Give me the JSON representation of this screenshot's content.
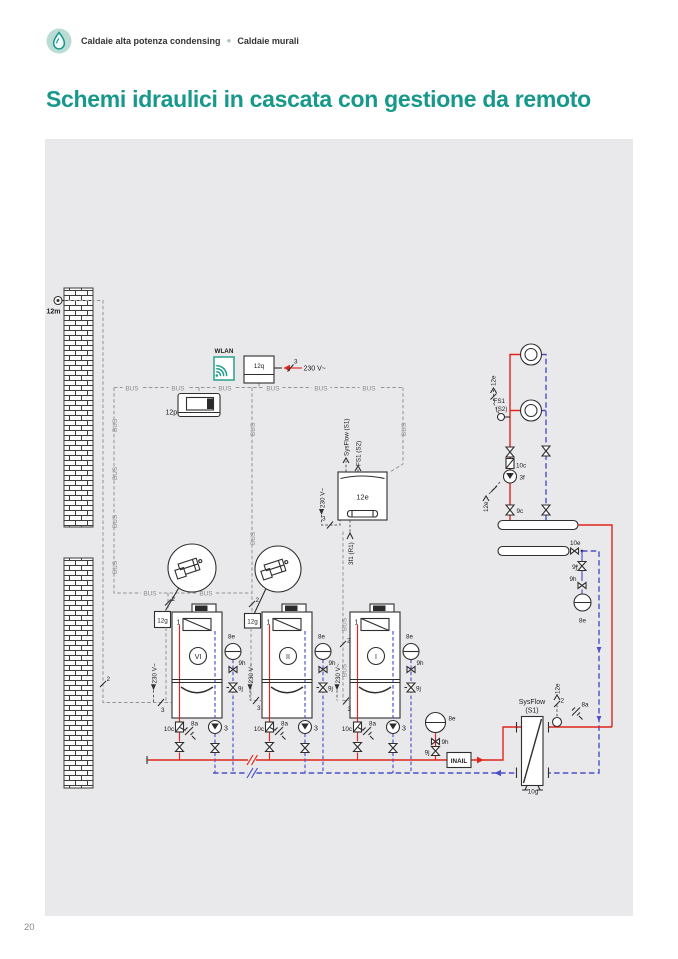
{
  "header": {
    "breadcrumb_1": "Caldaie alta potenza condensing",
    "separator": "●",
    "breadcrumb_2": "Caldaie murali"
  },
  "title": "Schemi idraulici in cascata con gestione da remoto",
  "footer": {
    "page_number": "20"
  },
  "colors": {
    "accent_teal": "#16998a",
    "supply_red": "#e0251c",
    "return_blue": "#4b50c8",
    "panel_gray": "#e9e9eb"
  },
  "icons": {
    "flame": "flame-icon",
    "wifi": "wifi-icon"
  },
  "diagram": {
    "bus": "BUS",
    "mains": "230 V~",
    "wlan": "WLAN",
    "wire2": "2",
    "wire3": "3",
    "one": "1",
    "outdoor_sensor": "12m",
    "gateway": "12q",
    "remote_panel": "12p",
    "cascade_manager": "12e",
    "boiler_interface": "12g",
    "sysflow_s1": "SysFlow (S1)",
    "fs1_s2": "FS1 (S2)",
    "relay_out": "3f1 (R1)",
    "sep_name_1": "SysFlow",
    "sep_name_2": "(S1)",
    "fs1_line1": "FS1",
    "fs1_line2": "(S2)",
    "boiler_6": "VI",
    "boiler_2": "II",
    "boiler_1": "I",
    "vessel": "8e",
    "valve_9h": "9h",
    "valve_9j": "9j",
    "check_10c": "10c",
    "safety_8a": "8a",
    "pump_3": "3",
    "pump_3f": "3f",
    "valve_9c": "9c",
    "valve_10e": "10e",
    "separator_10g": "10g",
    "inail": "INAIL"
  }
}
